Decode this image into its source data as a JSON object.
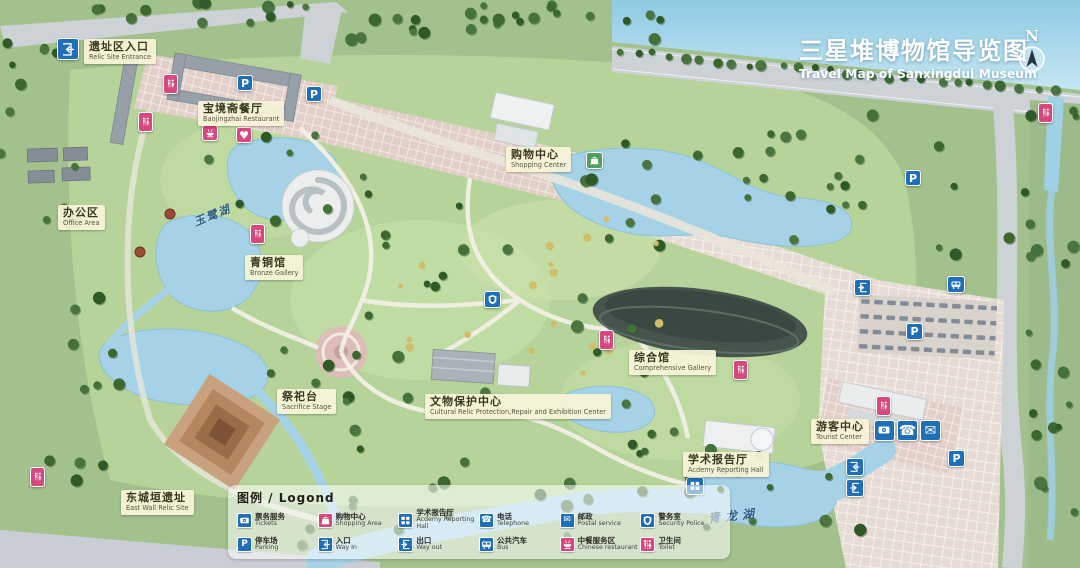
{
  "title": {
    "zh": "三星堆博物馆导览图",
    "en": "Travel Map of Sanxingdui Museum"
  },
  "north": {
    "label": "N"
  },
  "colors": {
    "icon_blue": "#1e6fb8",
    "icon_pink": "#d6487e",
    "icon_green": "#52a05f",
    "label_bg": "#f6f3d8",
    "water": "#a5d2e6",
    "title_text": "#ffffff"
  },
  "map": {
    "labels": [
      {
        "id": "relic-site-entrance",
        "zh": "遗址区入口",
        "en": "Relic Site Entrance",
        "x": 84,
        "y": 39
      },
      {
        "id": "baojingzhai-restaurant",
        "zh": "宝境斋餐厅",
        "en": "Baojingzhai Restaurant",
        "x": 198,
        "y": 101
      },
      {
        "id": "office-area",
        "zh": "办公区",
        "en": "Office Area",
        "x": 58,
        "y": 205
      },
      {
        "id": "shopping-center",
        "zh": "购物中心",
        "en": "Shopping Center",
        "x": 506,
        "y": 147
      },
      {
        "id": "bronze-gallery",
        "zh": "青铜馆",
        "en": "Bronze Gallery",
        "x": 245,
        "y": 255
      },
      {
        "id": "sacrifice-stage",
        "zh": "祭祀台",
        "en": "Sacrifice Stage",
        "x": 277,
        "y": 389
      },
      {
        "id": "cultural-relic-protection-center",
        "zh": "文物保护中心",
        "en": "Cultural Relic Protection,Repair and Exhibition Center",
        "x": 425,
        "y": 394
      },
      {
        "id": "comprehensive-gallery",
        "zh": "综合馆",
        "en": "Comprehensive Gallery",
        "x": 629,
        "y": 350
      },
      {
        "id": "academy-reporting-hall",
        "zh": "学术报告厅",
        "en": "Acdemy Reporting Hall",
        "x": 683,
        "y": 452
      },
      {
        "id": "tourist-center",
        "zh": "游客中心",
        "en": "Tourist Center",
        "x": 811,
        "y": 419
      },
      {
        "id": "east-wall-relic-site",
        "zh": "东城垣遗址",
        "en": "East Wall Relic Site",
        "x": 121,
        "y": 490
      }
    ],
    "lake_names": [
      {
        "id": "yulu-lake",
        "name": "玉鹭湖",
        "x": 193,
        "y": 207,
        "rot": -22,
        "size": 11,
        "spacing": 2
      },
      {
        "id": "qinglong-lake",
        "name": "青龙湖",
        "x": 708,
        "y": 507,
        "rot": -6,
        "size": 12,
        "spacing": 5
      }
    ],
    "icons": [
      {
        "type": "way-in",
        "x": 57,
        "y": 38,
        "w": 22,
        "h": 22,
        "color": "icon_blue"
      },
      {
        "type": "toilet",
        "x": 163,
        "y": 74,
        "w": 15,
        "h": 20,
        "color": "icon_pink"
      },
      {
        "type": "toilet",
        "x": 138,
        "y": 112,
        "w": 15,
        "h": 20,
        "color": "icon_pink"
      },
      {
        "type": "parking",
        "x": 237,
        "y": 75,
        "w": 16,
        "h": 16,
        "color": "icon_blue"
      },
      {
        "type": "parking",
        "x": 306,
        "y": 86,
        "w": 16,
        "h": 16,
        "color": "icon_blue"
      },
      {
        "type": "restaurant",
        "x": 202,
        "y": 125,
        "w": 16,
        "h": 16,
        "color": "icon_pink"
      },
      {
        "type": "heart",
        "x": 236,
        "y": 127,
        "w": 16,
        "h": 16,
        "color": "icon_pink"
      },
      {
        "type": "shopping",
        "x": 586,
        "y": 152,
        "w": 17,
        "h": 17,
        "color": "icon_green"
      },
      {
        "type": "toilet",
        "x": 250,
        "y": 224,
        "w": 15,
        "h": 20,
        "color": "icon_pink"
      },
      {
        "type": "security",
        "x": 484,
        "y": 291,
        "w": 17,
        "h": 17,
        "color": "icon_blue"
      },
      {
        "type": "toilet",
        "x": 599,
        "y": 330,
        "w": 15,
        "h": 20,
        "color": "icon_pink"
      },
      {
        "type": "toilet",
        "x": 733,
        "y": 360,
        "w": 15,
        "h": 20,
        "color": "icon_pink"
      },
      {
        "type": "way-out",
        "x": 854,
        "y": 279,
        "w": 17,
        "h": 17,
        "color": "icon_blue"
      },
      {
        "type": "bus",
        "x": 947,
        "y": 276,
        "w": 18,
        "h": 17,
        "color": "icon_blue"
      },
      {
        "type": "parking",
        "x": 905,
        "y": 170,
        "w": 16,
        "h": 16,
        "color": "icon_blue"
      },
      {
        "type": "parking",
        "x": 906,
        "y": 323,
        "w": 17,
        "h": 17,
        "color": "icon_blue"
      },
      {
        "type": "toilet",
        "x": 876,
        "y": 396,
        "w": 15,
        "h": 20,
        "color": "icon_pink"
      },
      {
        "type": "tickets",
        "x": 874,
        "y": 420,
        "w": 21,
        "h": 21,
        "color": "icon_blue"
      },
      {
        "type": "phone",
        "x": 897,
        "y": 420,
        "w": 21,
        "h": 21,
        "color": "icon_blue"
      },
      {
        "type": "mail",
        "x": 920,
        "y": 420,
        "w": 21,
        "h": 21,
        "color": "icon_blue"
      },
      {
        "type": "way-in",
        "x": 846,
        "y": 458,
        "w": 18,
        "h": 18,
        "color": "icon_blue"
      },
      {
        "type": "way-out",
        "x": 846,
        "y": 479,
        "w": 18,
        "h": 18,
        "color": "icon_blue"
      },
      {
        "type": "parking",
        "x": 948,
        "y": 450,
        "w": 17,
        "h": 17,
        "color": "icon_blue"
      },
      {
        "type": "academy",
        "x": 686,
        "y": 477,
        "w": 18,
        "h": 18,
        "color": "icon_blue"
      },
      {
        "type": "toilet",
        "x": 30,
        "y": 467,
        "w": 15,
        "h": 20,
        "color": "icon_pink"
      },
      {
        "type": "toilet",
        "x": 1038,
        "y": 103,
        "w": 15,
        "h": 20,
        "color": "icon_pink"
      }
    ]
  },
  "legend": {
    "title": "图例 / Logond",
    "items": [
      {
        "type": "tickets",
        "zh": "票务服务",
        "en": "Tickets",
        "color": "icon_blue"
      },
      {
        "type": "shopping",
        "zh": "购物中心",
        "en": "Shopping Area",
        "color": "icon_pink"
      },
      {
        "type": "academy",
        "zh": "学术报告厅",
        "en": "Acdemy Reporting Hall",
        "color": "icon_blue"
      },
      {
        "type": "phone",
        "zh": "电话",
        "en": "Telephone",
        "color": "icon_blue"
      },
      {
        "type": "mail",
        "zh": "邮政",
        "en": "Postal service",
        "color": "icon_blue"
      },
      {
        "type": "security",
        "zh": "警务室",
        "en": "Security Police",
        "color": "icon_blue"
      },
      {
        "type": "parking",
        "zh": "停车场",
        "en": "Parking",
        "color": "icon_blue"
      },
      {
        "type": "way-in",
        "zh": "入口",
        "en": "Way In",
        "color": "icon_blue"
      },
      {
        "type": "way-out",
        "zh": "出口",
        "en": "Way out",
        "color": "icon_blue"
      },
      {
        "type": "bus",
        "zh": "公共汽车",
        "en": "Bus",
        "color": "icon_blue"
      },
      {
        "type": "restaurant",
        "zh": "中餐服务区",
        "en": "Chinese restaurant",
        "color": "icon_pink"
      },
      {
        "type": "toilet",
        "zh": "卫生间",
        "en": "Toilet",
        "color": "icon_pink"
      }
    ]
  }
}
